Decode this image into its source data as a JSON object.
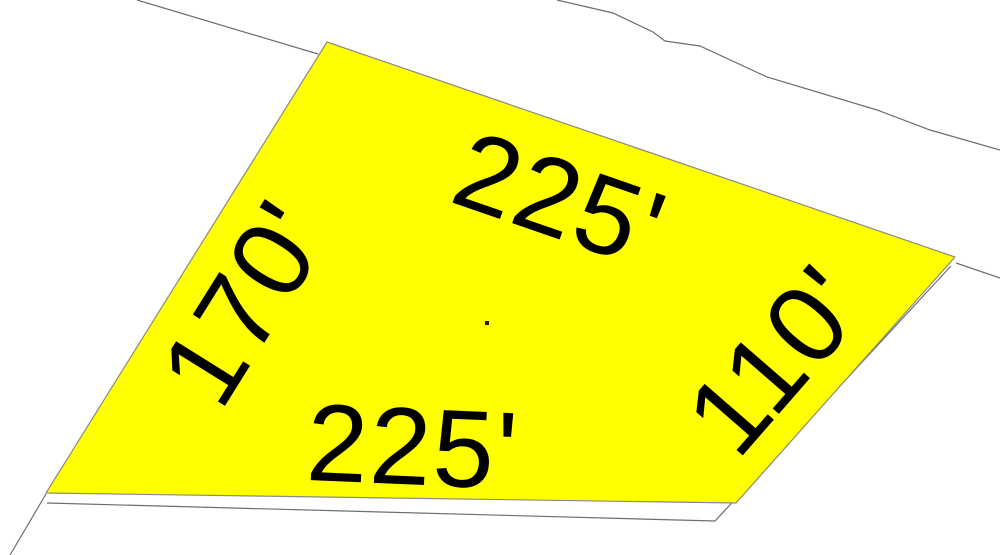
{
  "map": {
    "background_color": "#ffffff",
    "boundary_line_color": "#6e6e6e",
    "parcel": {
      "fill_color": "#ffff00",
      "outline_color": "#8a8a8a",
      "points": "327,42 955,257 736,503 46,493",
      "centroid_dot": {
        "x": "485",
        "y": "321",
        "size": "4",
        "color": "#1b1b00"
      }
    },
    "dimension_labels": [
      {
        "side": "top",
        "text": "225'",
        "transform": "translate(560,200) rotate(19)"
      },
      {
        "side": "left",
        "text": "170'",
        "transform": "translate(245,303) rotate(-58)"
      },
      {
        "side": "right",
        "text": "110'",
        "transform": "translate(776,360) rotate(-49)"
      },
      {
        "side": "bottom",
        "text": "225'",
        "transform": "translate(413,447) rotate(2.5)"
      }
    ],
    "label_color": "#000000",
    "boundary_lines": [
      {
        "name": "upper-left-boundary",
        "points": "137,0 318,54"
      },
      {
        "name": "upper-boundary",
        "points": "557,0 613,13 653,32 665,41 700,46 767,77 877,110 930,130 1000,150"
      },
      {
        "name": "right-corner-boundary",
        "points": "956,263 1000,278"
      },
      {
        "name": "lower-right-offset-boundary",
        "points": "47,503 715,521 951,266"
      },
      {
        "name": "lower-left-boundary",
        "points": "46,494 10,555"
      }
    ]
  }
}
